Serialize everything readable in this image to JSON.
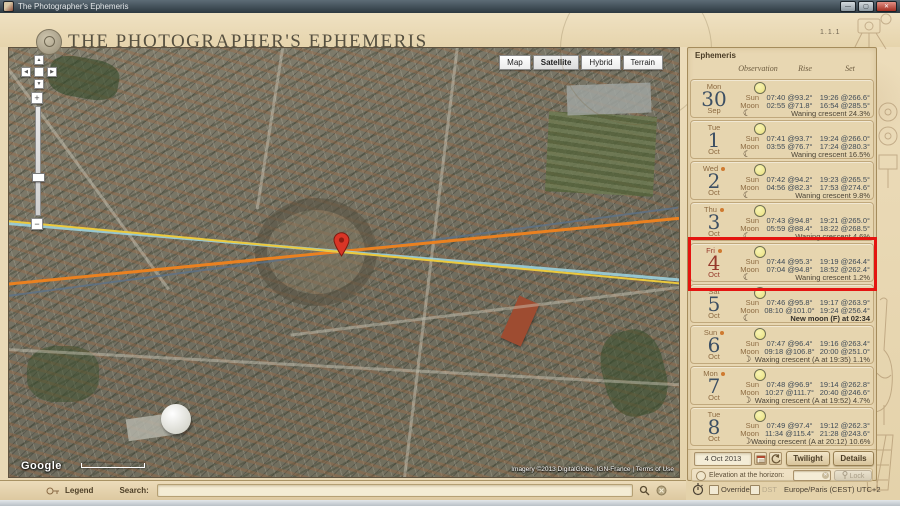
{
  "window": {
    "title": "The Photographer's Ephemeris"
  },
  "header": {
    "app_title": "THE PHOTOGRAPHER'S EPHEMERIS",
    "version": "1.1.1",
    "nav": [
      {
        "label": "Ephemeris",
        "active": true
      },
      {
        "label": "Locations",
        "active": false
      },
      {
        "label": "Configure",
        "active": false
      },
      {
        "label": "Glossary",
        "active": false
      },
      {
        "label": "About",
        "active": false
      }
    ],
    "elevation": "+13 m",
    "separator": "|",
    "coordinates": "43.6154°N, 4.0101°E"
  },
  "map": {
    "type_buttons": [
      {
        "label": "Map",
        "selected": false
      },
      {
        "label": "Satellite",
        "selected": true
      },
      {
        "label": "Hybrid",
        "selected": false
      },
      {
        "label": "Terrain",
        "selected": false
      }
    ],
    "logo": "Google",
    "attribution": "Imagery ©2013 DigitalGlobe, IGN-France | Terms of Use",
    "line_colors": {
      "sunrise": "#ecc93c",
      "sunset": "#ea8120",
      "moonrise": "#9ed6e4",
      "moonset": "#5c7288"
    },
    "pin_color": "#d93526"
  },
  "panel": {
    "title": "Ephemeris",
    "columns": [
      "Observation",
      "Rise",
      "Set"
    ],
    "labels": {
      "sun": "Sun",
      "moon": "Moon"
    },
    "rows": [
      {
        "day": "Mon",
        "date": "30",
        "month": "Sep",
        "flagged": false,
        "selected": false,
        "phase_bold": false,
        "sun_rise": "07:40 @93.2°",
        "sun_set": "19:26 @266.6°",
        "moon_rise": "02:55 @71.8°",
        "moon_set": "16:54 @285.5°",
        "phase": "Waning crescent 24.3%"
      },
      {
        "day": "Tue",
        "date": "1",
        "month": "Oct",
        "flagged": false,
        "selected": false,
        "phase_bold": false,
        "sun_rise": "07:41 @93.7°",
        "sun_set": "19:24 @266.0°",
        "moon_rise": "03:55 @76.7°",
        "moon_set": "17:24 @280.3°",
        "phase": "Waning crescent 16.5%"
      },
      {
        "day": "Wed",
        "date": "2",
        "month": "Oct",
        "flagged": true,
        "selected": false,
        "phase_bold": false,
        "sun_rise": "07:42 @94.2°",
        "sun_set": "19:23 @265.5°",
        "moon_rise": "04:56 @82.3°",
        "moon_set": "17:53 @274.6°",
        "phase": "Waning crescent 9.8%"
      },
      {
        "day": "Thu",
        "date": "3",
        "month": "Oct",
        "flagged": true,
        "selected": false,
        "phase_bold": false,
        "sun_rise": "07:43 @94.8°",
        "sun_set": "19:21 @265.0°",
        "moon_rise": "05:59 @88.4°",
        "moon_set": "18:22 @268.5°",
        "phase": "Waning crescent 4.6%"
      },
      {
        "day": "Fri",
        "date": "4",
        "month": "Oct",
        "flagged": true,
        "selected": true,
        "phase_bold": false,
        "sun_rise": "07:44 @95.3°",
        "sun_set": "19:19 @264.4°",
        "moon_rise": "07:04 @94.8°",
        "moon_set": "18:52 @262.4°",
        "phase": "Waning crescent 1.2%"
      },
      {
        "day": "Sat",
        "date": "5",
        "month": "Oct",
        "flagged": false,
        "selected": false,
        "phase_bold": true,
        "sun_rise": "07:46 @95.8°",
        "sun_set": "19:17 @263.9°",
        "moon_rise": "08:10 @101.0°",
        "moon_set": "19:24 @256.4°",
        "phase": "New moon (F) at 02:34"
      },
      {
        "day": "Sun",
        "date": "6",
        "month": "Oct",
        "flagged": true,
        "selected": false,
        "phase_bold": false,
        "sun_rise": "07:47 @96.4°",
        "sun_set": "19:16 @263.4°",
        "moon_rise": "09:18 @106.8°",
        "moon_set": "20:00 @251.0°",
        "phase": "Waxing crescent (A at 19:35) 1.1%"
      },
      {
        "day": "Mon",
        "date": "7",
        "month": "Oct",
        "flagged": true,
        "selected": false,
        "phase_bold": false,
        "sun_rise": "07:48 @96.9°",
        "sun_set": "19:14 @262.8°",
        "moon_rise": "10:27 @111.7°",
        "moon_set": "20:40 @246.6°",
        "phase": "Waxing crescent (A at 19:52) 4.7%"
      },
      {
        "day": "Tue",
        "date": "8",
        "month": "Oct",
        "flagged": false,
        "selected": false,
        "phase_bold": false,
        "sun_rise": "07:49 @97.4°",
        "sun_set": "19:12 @262.3°",
        "moon_rise": "11:34 @115.4°",
        "moon_set": "21:28 @243.6°",
        "phase": "Waxing crescent (A at 20:12) 10.6%"
      }
    ],
    "controls": {
      "date_value": "4 Oct 2013",
      "twilight": "Twilight",
      "details": "Details",
      "elevation_label": "Elevation at the horizon:",
      "lock": "Lock"
    }
  },
  "footer": {
    "legend": "Legend",
    "search_label": "Search:",
    "search_value": "",
    "override": "Override",
    "dst": "DST",
    "timezone": "Europe/Paris (CEST) UTC+2"
  },
  "icons": {
    "crescent": "☾",
    "up": "▲",
    "down": "▼",
    "left": "◀",
    "right": "▶",
    "plus": "+",
    "minus": "−"
  }
}
